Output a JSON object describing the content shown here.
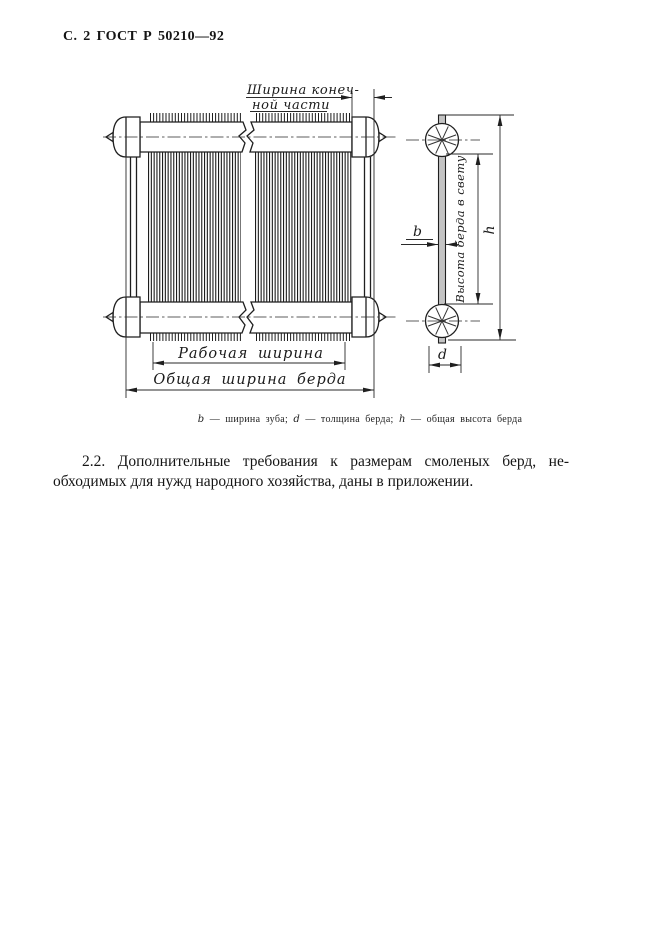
{
  "page": {
    "header": "С. 2 ГОСТ Р 50210—92"
  },
  "figure": {
    "labels": {
      "end_width_line1": "Ширина конеч-",
      "end_width_line2": "ной части",
      "working_width": "Рабочая ширина",
      "overall_width": "Общая ширина берда",
      "clear_height": "Высота берда в свету",
      "b": "b",
      "d": "d",
      "h": "h"
    },
    "caption": {
      "parts": [
        {
          "sym": "b",
          "desc": " — ширина зуба; "
        },
        {
          "sym": "d",
          "desc": " — толщина берда; "
        },
        {
          "sym": "h",
          "desc": " — общая высота берда"
        }
      ]
    }
  },
  "body_text": {
    "line1": "2.2. Дополнительные требования к размерам смоленых берд, не-",
    "line2": "обходимых для нужд народного хозяйства, даны в приложении."
  },
  "colors": {
    "ink": "#1b1b1b",
    "paper": "#ffffff"
  }
}
